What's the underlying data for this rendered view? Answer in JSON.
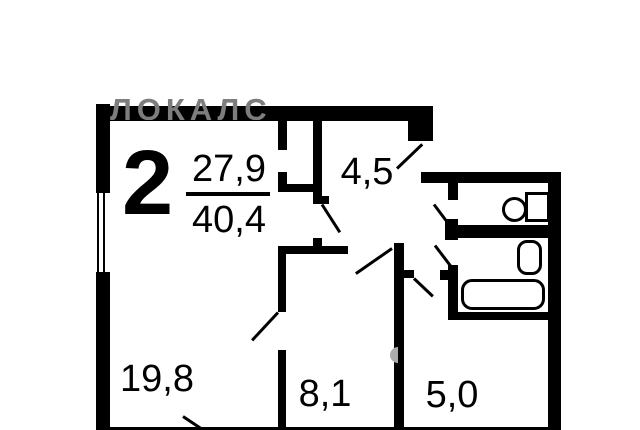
{
  "watermark": {
    "text": "ЛОКАЛС",
    "color": "#7d7d7d"
  },
  "summary": {
    "rooms_count": "2",
    "living_area": "27,9",
    "total_area": "40,4"
  },
  "rooms": {
    "hall": "4,5",
    "living": "19,8",
    "bedroom": "8,1",
    "kitchen": "5,0"
  },
  "fixtures": {
    "toilet": "toilet",
    "sink": "sink",
    "bathtub": "bathtub"
  },
  "colors": {
    "wall": "#000000",
    "background": "#ffffff",
    "watermark": "#7d7d7d"
  }
}
